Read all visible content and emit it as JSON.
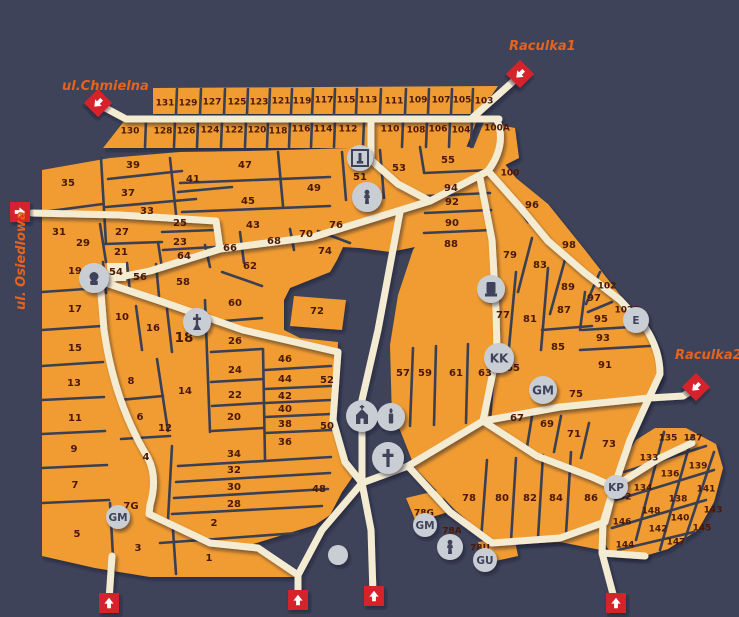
{
  "title": "Cmentarz Komunalny przy ulicy Wrocławskiej w Zielonej Górze",
  "map": {
    "colors": {
      "background": "#3E4359",
      "section_orange": "#F09C33",
      "path_cream": "#F4EBD3",
      "divider": "#3A3F54",
      "label": "#4A1804",
      "entrance_red": "#D6212B",
      "street_label": "#E8621B",
      "icon_circle": "#C9CDD4",
      "icon_glyph": "#3E4359",
      "title_text": "#FFFFFF"
    },
    "streets": [
      {
        "name": "ul.Chmielna",
        "x": 62,
        "y": 90,
        "rotate": 0
      },
      {
        "name": "Raculka1",
        "x": 509,
        "y": 50,
        "rotate": 0
      },
      {
        "name": "Raculka2",
        "x": 675,
        "y": 359,
        "rotate": 0
      },
      {
        "name": "ul. Osiedlowa",
        "x": 25,
        "y": 310,
        "rotate": -90
      }
    ],
    "entrances": [
      {
        "id": "chmielna",
        "x": 98,
        "y": 103,
        "shape": "diamond",
        "dir": 225
      },
      {
        "id": "raculka1",
        "x": 520,
        "y": 74,
        "shape": "diamond",
        "dir": 225
      },
      {
        "id": "osiedlowa",
        "x": 20,
        "y": 212,
        "shape": "square",
        "dir": 90
      },
      {
        "id": "raculka2",
        "x": 696,
        "y": 387,
        "shape": "diamond",
        "dir": 225
      },
      {
        "id": "south-1",
        "x": 109,
        "y": 603,
        "shape": "square",
        "dir": 0
      },
      {
        "id": "south-2",
        "x": 298,
        "y": 600,
        "shape": "square",
        "dir": 0
      },
      {
        "id": "south-3",
        "x": 374,
        "y": 596,
        "shape": "square",
        "dir": 0
      },
      {
        "id": "south-4",
        "x": 616,
        "y": 603,
        "shape": "square",
        "dir": 0
      }
    ],
    "icons": [
      {
        "type": "monument-outline",
        "x": 360,
        "y": 158,
        "r": 13
      },
      {
        "type": "statue",
        "x": 367,
        "y": 197,
        "r": 15
      },
      {
        "type": "bust",
        "x": 94,
        "y": 278,
        "r": 15
      },
      {
        "type": "angel",
        "x": 197,
        "y": 322,
        "r": 14
      },
      {
        "type": "monument",
        "x": 491,
        "y": 289,
        "r": 14
      },
      {
        "type": "letters",
        "label": "KK",
        "x": 499,
        "y": 358,
        "r": 15
      },
      {
        "type": "letters",
        "label": "E",
        "x": 636,
        "y": 320,
        "r": 13
      },
      {
        "type": "letters",
        "label": "GM",
        "x": 543,
        "y": 390,
        "r": 14
      },
      {
        "type": "chapel",
        "x": 362,
        "y": 416,
        "r": 16
      },
      {
        "type": "candle",
        "x": 391,
        "y": 417,
        "r": 14
      },
      {
        "type": "cross",
        "x": 388,
        "y": 458,
        "r": 16
      },
      {
        "type": "letters",
        "label": "GM",
        "x": 118,
        "y": 517,
        "r": 12
      },
      {
        "type": "letters",
        "label": "GM",
        "x": 425,
        "y": 525,
        "r": 12
      },
      {
        "type": "statue",
        "x": 450,
        "y": 547,
        "r": 13
      },
      {
        "type": "letters",
        "label": "GU",
        "x": 485,
        "y": 560,
        "r": 12
      },
      {
        "type": "letters",
        "label": "KP",
        "x": 616,
        "y": 487,
        "r": 12
      },
      {
        "type": "plain",
        "x": 338,
        "y": 555,
        "r": 10
      }
    ],
    "sections": [
      {
        "n": "131",
        "x": 165,
        "y": 103
      },
      {
        "n": "129",
        "x": 188,
        "y": 103
      },
      {
        "n": "127",
        "x": 212,
        "y": 102
      },
      {
        "n": "125",
        "x": 237,
        "y": 102
      },
      {
        "n": "123",
        "x": 259,
        "y": 102
      },
      {
        "n": "121",
        "x": 281,
        "y": 101
      },
      {
        "n": "119",
        "x": 302,
        "y": 101
      },
      {
        "n": "117",
        "x": 324,
        "y": 100
      },
      {
        "n": "115",
        "x": 346,
        "y": 100
      },
      {
        "n": "113",
        "x": 368,
        "y": 100
      },
      {
        "n": "111",
        "x": 394,
        "y": 101
      },
      {
        "n": "109",
        "x": 418,
        "y": 100
      },
      {
        "n": "107",
        "x": 441,
        "y": 100
      },
      {
        "n": "105",
        "x": 462,
        "y": 100
      },
      {
        "n": "103",
        "x": 484,
        "y": 101
      },
      {
        "n": "130",
        "x": 130,
        "y": 131
      },
      {
        "n": "128",
        "x": 163,
        "y": 131
      },
      {
        "n": "126",
        "x": 186,
        "y": 131
      },
      {
        "n": "124",
        "x": 210,
        "y": 130
      },
      {
        "n": "122",
        "x": 234,
        "y": 130
      },
      {
        "n": "120",
        "x": 257,
        "y": 130
      },
      {
        "n": "118",
        "x": 278,
        "y": 131
      },
      {
        "n": "116",
        "x": 301,
        "y": 129
      },
      {
        "n": "114",
        "x": 323,
        "y": 129
      },
      {
        "n": "112",
        "x": 348,
        "y": 129
      },
      {
        "n": "110",
        "x": 390,
        "y": 129
      },
      {
        "n": "108",
        "x": 416,
        "y": 130
      },
      {
        "n": "106",
        "x": 438,
        "y": 129
      },
      {
        "n": "104",
        "x": 461,
        "y": 130
      },
      {
        "n": "100A",
        "x": 497,
        "y": 128
      },
      {
        "n": "35",
        "x": 68,
        "y": 183
      },
      {
        "n": "39",
        "x": 133,
        "y": 165
      },
      {
        "n": "37",
        "x": 128,
        "y": 193
      },
      {
        "n": "41",
        "x": 193,
        "y": 179
      },
      {
        "n": "33",
        "x": 147,
        "y": 211
      },
      {
        "n": "31",
        "x": 59,
        "y": 232
      },
      {
        "n": "29",
        "x": 83,
        "y": 243
      },
      {
        "n": "27",
        "x": 122,
        "y": 232
      },
      {
        "n": "25",
        "x": 180,
        "y": 223
      },
      {
        "n": "23",
        "x": 180,
        "y": 242
      },
      {
        "n": "21",
        "x": 121,
        "y": 252
      },
      {
        "n": "64",
        "x": 184,
        "y": 256
      },
      {
        "n": "66",
        "x": 230,
        "y": 248
      },
      {
        "n": "19",
        "x": 75,
        "y": 271
      },
      {
        "n": "54",
        "x": 116,
        "y": 272
      },
      {
        "n": "56",
        "x": 140,
        "y": 277
      },
      {
        "n": "58",
        "x": 183,
        "y": 282
      },
      {
        "n": "17",
        "x": 75,
        "y": 309
      },
      {
        "n": "15",
        "x": 75,
        "y": 348
      },
      {
        "n": "13",
        "x": 74,
        "y": 383
      },
      {
        "n": "11",
        "x": 75,
        "y": 418
      },
      {
        "n": "9",
        "x": 74,
        "y": 449
      },
      {
        "n": "7",
        "x": 75,
        "y": 485
      },
      {
        "n": "5",
        "x": 77,
        "y": 534
      },
      {
        "n": "47",
        "x": 245,
        "y": 165
      },
      {
        "n": "45",
        "x": 248,
        "y": 201
      },
      {
        "n": "43",
        "x": 253,
        "y": 225
      },
      {
        "n": "49",
        "x": 314,
        "y": 188
      },
      {
        "n": "51",
        "x": 360,
        "y": 177
      },
      {
        "n": "53",
        "x": 399,
        "y": 168
      },
      {
        "n": "55",
        "x": 448,
        "y": 160
      },
      {
        "n": "76",
        "x": 336,
        "y": 225
      },
      {
        "n": "70",
        "x": 306,
        "y": 234
      },
      {
        "n": "68",
        "x": 274,
        "y": 241
      },
      {
        "n": "62",
        "x": 250,
        "y": 266
      },
      {
        "n": "74",
        "x": 325,
        "y": 251
      },
      {
        "n": "10",
        "x": 122,
        "y": 317
      },
      {
        "n": "16",
        "x": 153,
        "y": 328
      },
      {
        "n": "18",
        "x": 184,
        "y": 338
      },
      {
        "n": "60",
        "x": 235,
        "y": 303
      },
      {
        "n": "72",
        "x": 317,
        "y": 311
      },
      {
        "n": "26",
        "x": 235,
        "y": 341
      },
      {
        "n": "8",
        "x": 131,
        "y": 381
      },
      {
        "n": "14",
        "x": 185,
        "y": 391
      },
      {
        "n": "6",
        "x": 140,
        "y": 417
      },
      {
        "n": "12",
        "x": 165,
        "y": 428
      },
      {
        "n": "4",
        "x": 146,
        "y": 457
      },
      {
        "n": "24",
        "x": 235,
        "y": 370
      },
      {
        "n": "22",
        "x": 235,
        "y": 395
      },
      {
        "n": "20",
        "x": 234,
        "y": 417
      },
      {
        "n": "46",
        "x": 285,
        "y": 359
      },
      {
        "n": "44",
        "x": 285,
        "y": 379
      },
      {
        "n": "42",
        "x": 285,
        "y": 396
      },
      {
        "n": "40",
        "x": 285,
        "y": 409
      },
      {
        "n": "38",
        "x": 285,
        "y": 424
      },
      {
        "n": "36",
        "x": 285,
        "y": 442
      },
      {
        "n": "52",
        "x": 327,
        "y": 380
      },
      {
        "n": "50",
        "x": 327,
        "y": 426
      },
      {
        "n": "34",
        "x": 234,
        "y": 454
      },
      {
        "n": "32",
        "x": 234,
        "y": 470
      },
      {
        "n": "30",
        "x": 234,
        "y": 487
      },
      {
        "n": "28",
        "x": 234,
        "y": 504
      },
      {
        "n": "48",
        "x": 319,
        "y": 489
      },
      {
        "n": "2",
        "x": 214,
        "y": 523
      },
      {
        "n": "3",
        "x": 138,
        "y": 548
      },
      {
        "n": "1",
        "x": 209,
        "y": 558
      },
      {
        "n": "7G",
        "x": 131,
        "y": 506
      },
      {
        "n": "94",
        "x": 451,
        "y": 188
      },
      {
        "n": "92",
        "x": 452,
        "y": 202
      },
      {
        "n": "90",
        "x": 452,
        "y": 223
      },
      {
        "n": "88",
        "x": 451,
        "y": 244
      },
      {
        "n": "100",
        "x": 510,
        "y": 173
      },
      {
        "n": "96",
        "x": 532,
        "y": 205
      },
      {
        "n": "98",
        "x": 569,
        "y": 245
      },
      {
        "n": "79",
        "x": 510,
        "y": 255
      },
      {
        "n": "83",
        "x": 540,
        "y": 265
      },
      {
        "n": "89",
        "x": 568,
        "y": 287
      },
      {
        "n": "102",
        "x": 607,
        "y": 286
      },
      {
        "n": "97",
        "x": 594,
        "y": 298
      },
      {
        "n": "87",
        "x": 564,
        "y": 310
      },
      {
        "n": "77",
        "x": 503,
        "y": 315
      },
      {
        "n": "81",
        "x": 530,
        "y": 319
      },
      {
        "n": "95",
        "x": 601,
        "y": 319
      },
      {
        "n": "102E",
        "x": 627,
        "y": 310
      },
      {
        "n": "93",
        "x": 603,
        "y": 338
      },
      {
        "n": "85",
        "x": 558,
        "y": 347
      },
      {
        "n": "91",
        "x": 605,
        "y": 365
      },
      {
        "n": "75",
        "x": 576,
        "y": 394
      },
      {
        "n": "57",
        "x": 403,
        "y": 373
      },
      {
        "n": "59",
        "x": 425,
        "y": 373
      },
      {
        "n": "61",
        "x": 456,
        "y": 373
      },
      {
        "n": "63",
        "x": 485,
        "y": 373
      },
      {
        "n": "65",
        "x": 513,
        "y": 368
      },
      {
        "n": "67",
        "x": 517,
        "y": 418
      },
      {
        "n": "69",
        "x": 547,
        "y": 424
      },
      {
        "n": "71",
        "x": 574,
        "y": 434
      },
      {
        "n": "73",
        "x": 609,
        "y": 444
      },
      {
        "n": "78",
        "x": 469,
        "y": 498
      },
      {
        "n": "80",
        "x": 502,
        "y": 498
      },
      {
        "n": "82",
        "x": 530,
        "y": 498
      },
      {
        "n": "84",
        "x": 556,
        "y": 498
      },
      {
        "n": "86",
        "x": 591,
        "y": 498
      },
      {
        "n": "78G",
        "x": 424,
        "y": 513
      },
      {
        "n": "78A",
        "x": 452,
        "y": 531
      },
      {
        "n": "78U",
        "x": 480,
        "y": 548
      },
      {
        "n": "132",
        "x": 622,
        "y": 497
      },
      {
        "n": "135",
        "x": 668,
        "y": 438
      },
      {
        "n": "137",
        "x": 693,
        "y": 438
      },
      {
        "n": "133",
        "x": 649,
        "y": 458
      },
      {
        "n": "139",
        "x": 698,
        "y": 466
      },
      {
        "n": "136",
        "x": 670,
        "y": 474
      },
      {
        "n": "134",
        "x": 643,
        "y": 488
      },
      {
        "n": "141",
        "x": 706,
        "y": 489
      },
      {
        "n": "138",
        "x": 678,
        "y": 499
      },
      {
        "n": "148",
        "x": 651,
        "y": 511
      },
      {
        "n": "143",
        "x": 713,
        "y": 510
      },
      {
        "n": "146",
        "x": 622,
        "y": 522
      },
      {
        "n": "140",
        "x": 680,
        "y": 518
      },
      {
        "n": "142",
        "x": 658,
        "y": 529
      },
      {
        "n": "145",
        "x": 702,
        "y": 528
      },
      {
        "n": "144",
        "x": 625,
        "y": 545
      },
      {
        "n": "147",
        "x": 676,
        "y": 542
      }
    ]
  }
}
